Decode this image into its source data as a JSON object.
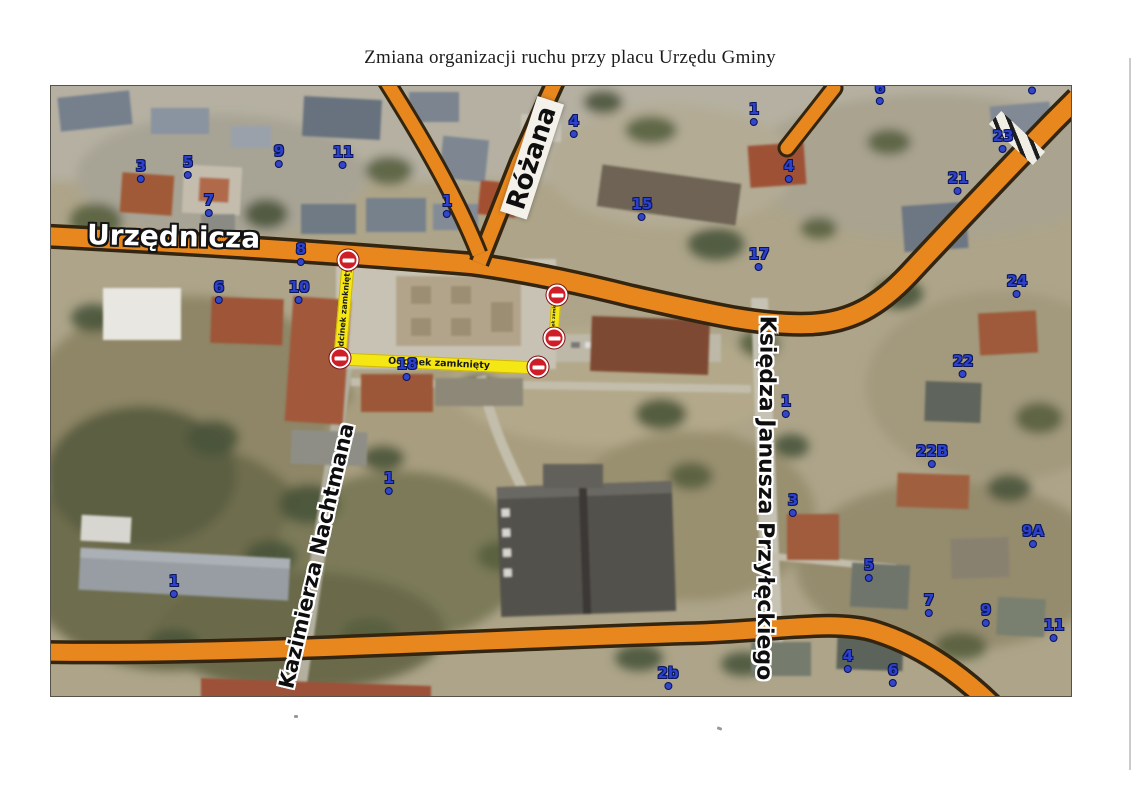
{
  "page": {
    "title": "Zmiana organizacji ruchu przy placu Urzędu Gminy"
  },
  "map": {
    "streets": [
      {
        "id": "urzednicza",
        "name": "Urzędnicza"
      },
      {
        "id": "rozana",
        "name": "Różana"
      },
      {
        "id": "nachtmana",
        "name": "Kazimierza Nachtmana"
      },
      {
        "id": "przyleckiego",
        "name": "Księdza Janusza Przyłęckiego"
      }
    ],
    "closures": [
      {
        "label": "Odcinek zamknięty",
        "cx": 293,
        "cy": 224,
        "len": 102,
        "th": 13,
        "angle": -85,
        "fs": 8
      },
      {
        "label": "Odcinek zamknięty",
        "cx": 504,
        "cy": 231,
        "len": 46,
        "th": 10,
        "angle": -86,
        "fs": 4.5
      },
      {
        "label": "Odcinek zamknięty",
        "cx": 388,
        "cy": 277,
        "len": 200,
        "th": 13,
        "angle": 2.6,
        "fs": 9.5
      }
    ],
    "no_entry_signs": [
      {
        "x": 297,
        "y": 174
      },
      {
        "x": 289,
        "y": 272
      },
      {
        "x": 487,
        "y": 281
      },
      {
        "x": 506,
        "y": 209
      },
      {
        "x": 503,
        "y": 252
      }
    ],
    "house_numbers": [
      {
        "n": "3",
        "x": 90,
        "y": 85
      },
      {
        "n": "5",
        "x": 137,
        "y": 81
      },
      {
        "n": "7",
        "x": 158,
        "y": 119
      },
      {
        "n": "9",
        "x": 228,
        "y": 70
      },
      {
        "n": "11",
        "x": 292,
        "y": 71
      },
      {
        "n": "8",
        "x": 250,
        "y": 168
      },
      {
        "n": "6",
        "x": 168,
        "y": 206
      },
      {
        "n": "10",
        "x": 248,
        "y": 206
      },
      {
        "n": "18",
        "x": 356,
        "y": 283
      },
      {
        "n": "1",
        "x": 396,
        "y": 120
      },
      {
        "n": "4",
        "x": 523,
        "y": 40
      },
      {
        "n": "15",
        "x": 591,
        "y": 123
      },
      {
        "n": "17",
        "x": 708,
        "y": 173
      },
      {
        "n": "1",
        "x": 703,
        "y": 28
      },
      {
        "n": "4",
        "x": 738,
        "y": 85
      },
      {
        "n": "6",
        "x": 829,
        "y": 7
      },
      {
        "n": "",
        "x": 981,
        "y": 4
      },
      {
        "n": "23",
        "x": 952,
        "y": 55
      },
      {
        "n": "21",
        "x": 907,
        "y": 97
      },
      {
        "n": "24",
        "x": 966,
        "y": 200
      },
      {
        "n": "22",
        "x": 912,
        "y": 280
      },
      {
        "n": "22B",
        "x": 881,
        "y": 370
      },
      {
        "n": "1",
        "x": 735,
        "y": 320
      },
      {
        "n": "3",
        "x": 742,
        "y": 419
      },
      {
        "n": "9A",
        "x": 982,
        "y": 450
      },
      {
        "n": "5",
        "x": 818,
        "y": 484
      },
      {
        "n": "7",
        "x": 878,
        "y": 519
      },
      {
        "n": "9",
        "x": 935,
        "y": 529
      },
      {
        "n": "11",
        "x": 1003,
        "y": 544
      },
      {
        "n": "4",
        "x": 797,
        "y": 575
      },
      {
        "n": "6",
        "x": 842,
        "y": 589
      },
      {
        "n": "2b",
        "x": 617,
        "y": 592
      },
      {
        "n": "1",
        "x": 338,
        "y": 397
      },
      {
        "n": "1",
        "x": 123,
        "y": 500
      }
    ],
    "colors": {
      "road_orange": "#e8871e",
      "road_outline": "#33250f",
      "closure_yellow": "#f4e714",
      "sign_red": "#ce1f28",
      "number_blue": "#2c41cd"
    }
  }
}
